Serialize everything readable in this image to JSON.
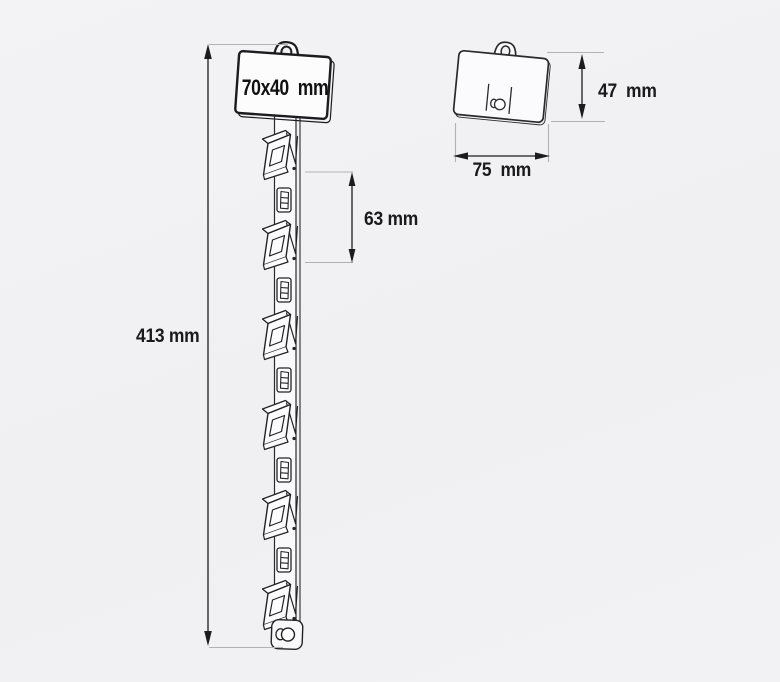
{
  "drawing": {
    "strip": {
      "card_size_label": "70x40  mm",
      "total_height_label": "413 mm",
      "clip_spacing_label": "63 mm",
      "clip_count": 6,
      "slot_count": 5
    },
    "header_card": {
      "height_label": "47  mm",
      "width_label": "75  mm"
    }
  },
  "colors": {
    "background": "#f1f1f3",
    "line": "#1c1c1e",
    "extension_line": "#b2b2b5",
    "text": "#1a1a1a",
    "part_fill": "#fbfbfd"
  }
}
